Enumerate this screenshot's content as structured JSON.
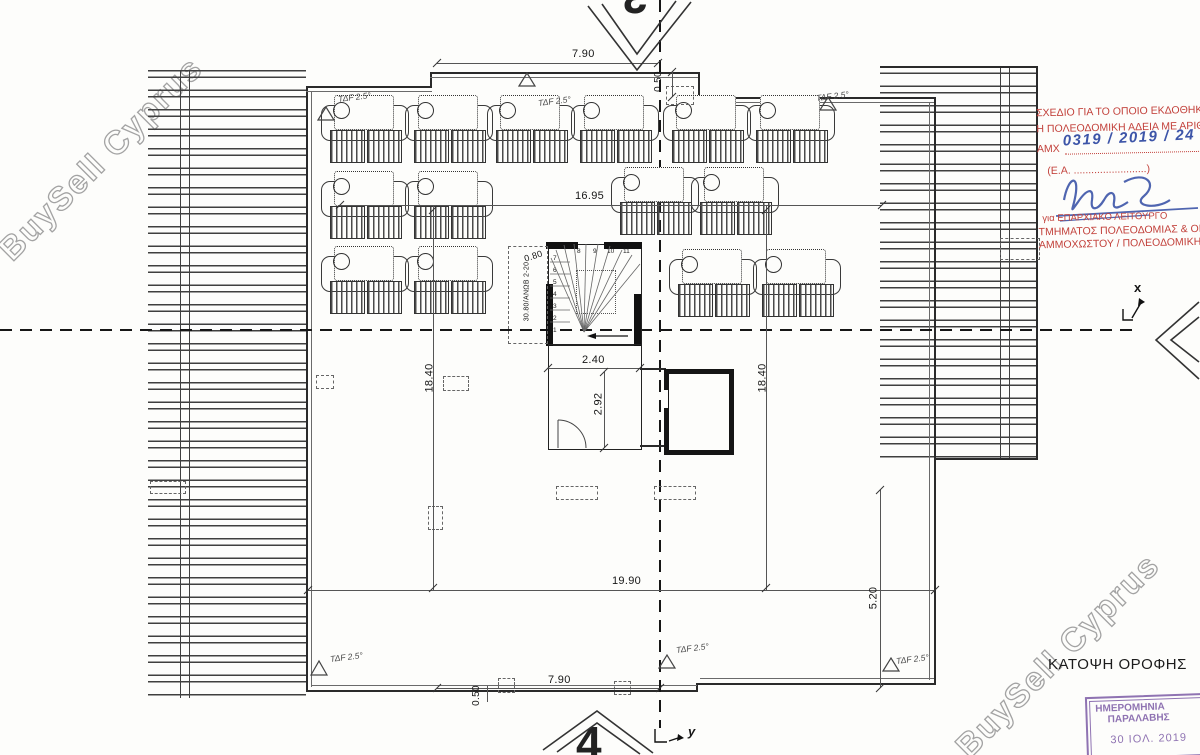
{
  "colors": {
    "stamp-red": "#c2403a",
    "ink-blue": "#3d55a8",
    "stamp-purple": "#8465ab",
    "watermark": "#a3a3a3"
  },
  "watermark": {
    "text": "BuySell Cyprus"
  },
  "drawing": {
    "title": "ΚΑΤΟΨΗ ΟΡΟΦΗΣ",
    "sheet_markers": {
      "top": "3",
      "bottom": "4"
    },
    "axis": {
      "x": "x",
      "y": "y"
    },
    "slope_note": "ΤΔF 2.5°",
    "dimensions": {
      "top_width": "7.90",
      "top_step": "0.50",
      "upper_width": "16.95",
      "left_height": "18.40",
      "right_height": "18.40",
      "lower_width": "19.90",
      "right_lower_height": "5.20",
      "bottom_width": "7.90",
      "bottom_step": "0.50",
      "stair_entry": "0.80",
      "stair_width": "2.40",
      "lobby_depth": "2.92",
      "stair_note": "30.80/ΑΝΩΒ 2-20"
    },
    "stair_numbers": [
      "1",
      "2",
      "3",
      "4",
      "5",
      "6",
      "7",
      "8",
      "9",
      "10",
      "11"
    ]
  },
  "approval_stamp": {
    "line1": "ΣΧΕΔΙΟ ΓΙΑ ΤΟ ΟΠΟΙΟ ΕΚΔΟΘΗΚ",
    "line2": "Η ΠΟΛΕΟΔΟΜΙΚΗ ΑΔΕΙΑ ΜΕ ΑΡΙΘΜ",
    "ref_prefix": "ΑΜΧ",
    "ref_number": "0319 / 2019 / 24",
    "ea_line": "(Ε.Α. .........................)",
    "for_line": "για ΕΠΑΡΧΙΑΚΟ ΛΕΙΤΟΥΡΓΟ",
    "dept_line1": "ΤΜΗΜΑΤΟΣ ΠΟΛΕΟΔΟΜΙΑΣ & ΟΙΚΗΣ",
    "dept_line2": "ΑΜΜΟΧΩΣΤΟΥ / ΠΟΛΕΟΔΟΜΙΚΗ ΑΡ"
  },
  "receipt_stamp": {
    "line1": "ΗΜΕΡΟΜΗΝΙΑ",
    "line2": "ΠΑΡΑΛΑΒΗΣ",
    "date": "30 ΙΟΛ. 2019"
  }
}
